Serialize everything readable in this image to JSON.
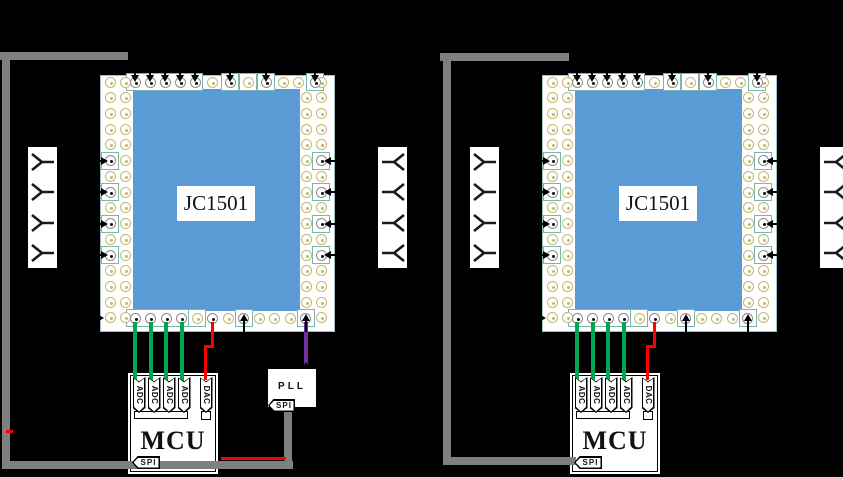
{
  "scene": {
    "background": "#000000",
    "palette": {
      "die": "#5b9bd5",
      "package": "#ffffff",
      "pad_ring_olive": "#c2b96d",
      "pad_ring_gray": "#8a8a8a",
      "pad_box_teal": "#7ab5b0",
      "arrow_black": "#000000"
    },
    "wires": {
      "spi_bus": "#7f7f7f",
      "adc": "#00a651",
      "dac": "#ff0000",
      "pll_clock": "#7030a0"
    },
    "package_pads": {
      "top": [
        "arrow",
        "arrow",
        "arrow",
        "arrow",
        "arrow",
        "olive",
        "arrow",
        "olive-box",
        "arrow",
        "olive",
        "olive",
        "arrow"
      ],
      "bottom": [
        "wire-adc",
        "wire-adc",
        "wire-adc",
        "wire-adc",
        "olive-box",
        "wire-dac",
        "olive",
        "up-arrow",
        "olive",
        "olive",
        "olive",
        "up-arrow"
      ],
      "side_arrow_rows_left": 4,
      "side_arrow_rows_right": 4
    },
    "boards": [
      {
        "chip_label": "JC1501",
        "mcu": {
          "label": "MCU",
          "pins": [
            "ADC",
            "ADC",
            "ADC",
            "ADC",
            "DAC"
          ],
          "bus_label": "SPI"
        },
        "pll": {
          "label": "PLL",
          "bus_label": "SPI"
        },
        "antennas_left": 4,
        "antennas_right": 4
      },
      {
        "chip_label": "JC1501",
        "mcu": {
          "label": "MCU",
          "pins": [
            "ADC",
            "ADC",
            "ADC",
            "ADC",
            "DAC"
          ],
          "bus_label": "SPI"
        },
        "pll": null,
        "antennas_left": 4,
        "antennas_right": 4
      }
    ]
  }
}
